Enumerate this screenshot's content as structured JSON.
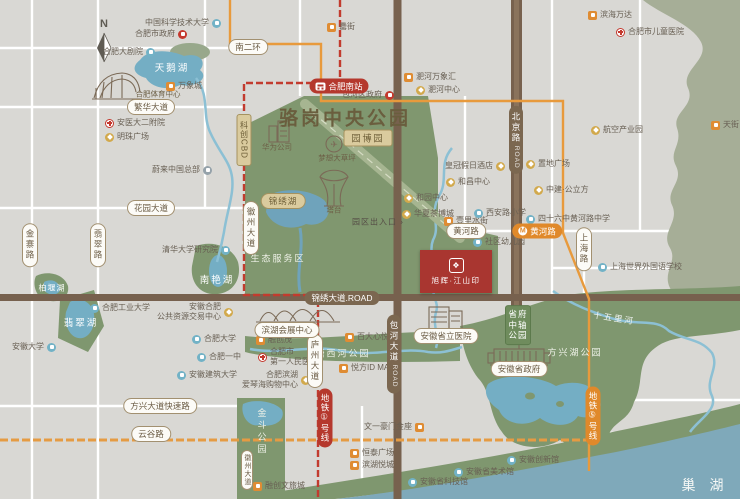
{
  "compass": "N",
  "project": {
    "name": "旭辉·江山印",
    "logo_glyph": "❖"
  },
  "icons": {
    "metro_glyph": "M",
    "plane_glyph": "✈"
  },
  "colors": {
    "background": "#d9d8d4",
    "park_green": "#80976f",
    "light_green": "#a6ae97",
    "water": "#74aec4",
    "lake_chaohu": "#7fa9ba",
    "road_brown": "#77614e",
    "metro_line1_red": "#c23b2e",
    "metro_line5_orange": "#e89a3c",
    "project_red": "#a93630",
    "pill_brown": "#7b6750"
  },
  "big_labels": [
    {
      "t": "骆岗中央公园",
      "x": 345,
      "y": 117,
      "cls": "park-title"
    },
    {
      "t": "巢 湖",
      "x": 705,
      "y": 485,
      "cls": "big-lake"
    },
    {
      "t": "天鹅湖",
      "x": 172,
      "y": 67,
      "cls": "lake"
    },
    {
      "t": "翡翠湖",
      "x": 81,
      "y": 322,
      "cls": "lake"
    },
    {
      "t": "南艳湖",
      "x": 217,
      "y": 279,
      "cls": "lake"
    },
    {
      "t": "柏堰湖",
      "x": 52,
      "y": 288,
      "cls": "lake-sm"
    },
    {
      "t": "生态服务区",
      "x": 278,
      "y": 258,
      "cls": "area"
    },
    {
      "t": "金斗公园",
      "x": 262,
      "y": 432,
      "cls": "area-v"
    },
    {
      "t": "塘西河公园",
      "x": 343,
      "y": 353,
      "cls": "area"
    },
    {
      "t": "方兴湖公园",
      "x": 575,
      "y": 352,
      "cls": "area"
    },
    {
      "t": "十五里河",
      "x": 614,
      "y": 318,
      "cls": "river"
    },
    {
      "t": "园区出入口 ›",
      "x": 378,
      "y": 222,
      "cls": "gate"
    },
    {
      "t": "塔台",
      "x": 334,
      "y": 210,
      "cls": "sketch-label"
    },
    {
      "t": "华为公司",
      "x": 277,
      "y": 147,
      "cls": "sketch-label"
    },
    {
      "t": "梦想大草坪",
      "x": 337,
      "y": 158,
      "cls": "sketch-label"
    },
    {
      "t": "合肥体育中心",
      "x": 158,
      "y": 94,
      "cls": "sketch-label"
    }
  ],
  "badges": [
    {
      "t": "园博园",
      "x": 368,
      "y": 138,
      "cls": "khaki"
    },
    {
      "t": "锦绣湖",
      "x": 283,
      "y": 201,
      "cls": "khaki-r"
    },
    {
      "t": "科创CBD",
      "x": 244,
      "y": 140,
      "cls": "khaki-v"
    },
    {
      "t": "省府中轴公园",
      "x": 518,
      "y": 325,
      "cls": "green-v"
    }
  ],
  "pills": [
    {
      "t": "南二环",
      "x": 248,
      "y": 47
    },
    {
      "t": "繁华大道",
      "x": 151,
      "y": 107
    },
    {
      "t": "花园大道",
      "x": 151,
      "y": 208
    },
    {
      "t": "金寨路",
      "x": 30,
      "y": 245,
      "v": 1
    },
    {
      "t": "翡翠路",
      "x": 98,
      "y": 245,
      "v": 1
    },
    {
      "t": "黄河路",
      "x": 466,
      "y": 231
    },
    {
      "t": "上海路",
      "x": 584,
      "y": 249,
      "v": 1
    },
    {
      "t": "徽州大道",
      "x": 251,
      "y": 228,
      "v": 1
    },
    {
      "t": "庐州大道",
      "x": 315,
      "y": 361,
      "v": 1
    },
    {
      "t": "徽州大道",
      "x": 247,
      "y": 470,
      "v": 1,
      "small": 1
    },
    {
      "t": "方兴大道快速路",
      "x": 160,
      "y": 406
    },
    {
      "t": "云谷路",
      "x": 151,
      "y": 434
    },
    {
      "t": "安徽省政府",
      "x": 519,
      "y": 369
    },
    {
      "t": "安徽省立医院",
      "x": 446,
      "y": 336
    },
    {
      "t": "滨湖会展中心",
      "x": 287,
      "y": 330
    }
  ],
  "brown_pills": [
    {
      "t": "锦绣大道.ROAD",
      "x": 342,
      "y": 298
    },
    {
      "t": "北京路",
      "sub": "ROAD",
      "x": 516,
      "y": 140,
      "v": 1
    },
    {
      "t": "包河大道",
      "sub": "ROAD",
      "x": 394,
      "y": 354,
      "v": 1
    }
  ],
  "metro_badges": [
    {
      "t": "合肥南站",
      "x": 339,
      "y": 86,
      "cls": "red",
      "icon": "train"
    },
    {
      "t": "黄河路",
      "x": 537,
      "y": 231,
      "cls": "orange",
      "icon": "metro"
    },
    {
      "t": "地铁①号线",
      "x": 325,
      "y": 418,
      "cls": "red",
      "v": 1
    },
    {
      "t": "地铁⑤号线",
      "x": 593,
      "y": 416,
      "cls": "orange",
      "v": 1
    }
  ],
  "pois": [
    {
      "t": "中国科学技术大学",
      "x": 216,
      "y": 23,
      "ic": "sch",
      "side": "r"
    },
    {
      "t": "合肥市政府",
      "x": 182,
      "y": 34,
      "ic": "gov",
      "side": "r"
    },
    {
      "t": "合肥大剧院",
      "x": 150,
      "y": 52,
      "ic": "sch",
      "side": "r"
    },
    {
      "t": "万象城",
      "x": 171,
      "y": 86,
      "ic": "mal"
    },
    {
      "t": "安医大二附院",
      "x": 110,
      "y": 123,
      "ic": "hos"
    },
    {
      "t": "明珠广场",
      "x": 110,
      "y": 137,
      "ic": "gld"
    },
    {
      "t": "蔚来中国总部",
      "x": 207,
      "y": 170,
      "ic": "nio",
      "side": "r"
    },
    {
      "t": "罍街",
      "x": 332,
      "y": 27,
      "ic": "mal"
    },
    {
      "t": "包河区政府",
      "x": 389,
      "y": 95,
      "ic": "gov",
      "side": "r"
    },
    {
      "t": "淝河万象汇",
      "x": 409,
      "y": 77,
      "ic": "mal"
    },
    {
      "t": "淝河中心",
      "x": 421,
      "y": 90,
      "ic": "gld"
    },
    {
      "t": "滨海万达",
      "x": 593,
      "y": 15,
      "ic": "mal"
    },
    {
      "t": "合肥市儿童医院",
      "x": 621,
      "y": 32,
      "ic": "hos"
    },
    {
      "t": "天街",
      "x": 716,
      "y": 125,
      "ic": "mal"
    },
    {
      "t": "航空产业园",
      "x": 596,
      "y": 130,
      "ic": "gld"
    },
    {
      "t": "皇冠假日酒店",
      "x": 500,
      "y": 166,
      "ic": "gld",
      "side": "r"
    },
    {
      "t": "置地广场",
      "x": 531,
      "y": 164,
      "ic": "gld"
    },
    {
      "t": "中建·公立方",
      "x": 539,
      "y": 190,
      "ic": "gld"
    },
    {
      "t": "和昌中心",
      "x": 451,
      "y": 182,
      "ic": "gld"
    },
    {
      "t": "和园中心",
      "x": 409,
      "y": 198,
      "ic": "gld"
    },
    {
      "t": "华夏茶博城",
      "x": 407,
      "y": 214,
      "ic": "gld"
    },
    {
      "t": "壹里水街",
      "x": 449,
      "y": 221,
      "ic": "mal"
    },
    {
      "t": "西安路小学",
      "x": 479,
      "y": 213,
      "ic": "sch"
    },
    {
      "t": "四十六中黄河路中学",
      "x": 531,
      "y": 219,
      "ic": "sch"
    },
    {
      "t": "社区幼儿园",
      "x": 478,
      "y": 242,
      "ic": "sch"
    },
    {
      "t": "上海世界外国语学校",
      "x": 603,
      "y": 267,
      "ic": "sch"
    },
    {
      "t": "清华大学研究院",
      "x": 225,
      "y": 250,
      "ic": "sch",
      "side": "r"
    },
    {
      "t": "合肥工业大学",
      "x": 95,
      "y": 308,
      "ic": "sch"
    },
    {
      "t": "安徽大学",
      "x": 51,
      "y": 347,
      "ic": "sch",
      "side": "r"
    },
    {
      "t": "安徽合肥",
      "l2": "公共资源交易中心",
      "x": 228,
      "y": 312,
      "ic": "gld",
      "side": "r"
    },
    {
      "t": "合肥大学",
      "x": 197,
      "y": 339,
      "ic": "sch"
    },
    {
      "t": "合肥一中",
      "x": 202,
      "y": 357,
      "ic": "sch"
    },
    {
      "t": "安徽建筑大学",
      "x": 182,
      "y": 375,
      "ic": "sch"
    },
    {
      "t": "融创茂",
      "x": 261,
      "y": 340,
      "ic": "mal"
    },
    {
      "t": "合肥市",
      "l2": "第一人民医院",
      "x": 263,
      "y": 357,
      "ic": "hos"
    },
    {
      "t": "合肥滨湖",
      "l2": "爱琴海购物中心",
      "x": 305,
      "y": 380,
      "ic": "gld",
      "side": "r"
    },
    {
      "t": "百大心悦城",
      "x": 350,
      "y": 337,
      "ic": "mal"
    },
    {
      "t": "悦方ID MALL",
      "x": 344,
      "y": 368,
      "ic": "mal"
    },
    {
      "t": "文一豪门金座",
      "x": 419,
      "y": 427,
      "ic": "mal",
      "side": "r"
    },
    {
      "t": "恒泰广场",
      "x": 355,
      "y": 453,
      "ic": "mal"
    },
    {
      "t": "滨湖悦城",
      "x": 355,
      "y": 465,
      "ic": "mal"
    },
    {
      "t": "融创文旅城",
      "x": 258,
      "y": 486,
      "ic": "mal"
    },
    {
      "t": "安徽省科技馆",
      "x": 413,
      "y": 482,
      "ic": "sch"
    },
    {
      "t": "安徽省美术馆",
      "x": 459,
      "y": 472,
      "ic": "sch"
    },
    {
      "t": "安徽创新馆",
      "x": 512,
      "y": 460,
      "ic": "sch"
    }
  ]
}
